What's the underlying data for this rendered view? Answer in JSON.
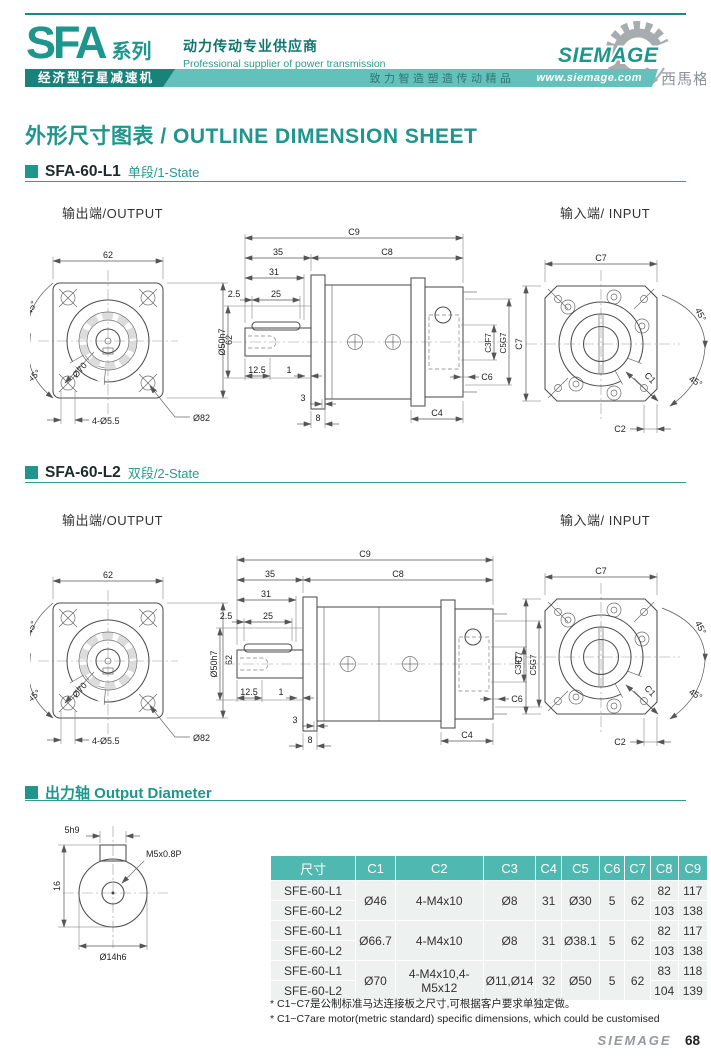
{
  "header": {
    "series": "SFA",
    "series_suffix": "系列",
    "slogan_cn": "动力传动专业供应商",
    "slogan_en": "Professional supplier of power transmission",
    "banner_product": "经济型行星减速机",
    "banner_slogan": "致力智造塑造传动精品",
    "banner_url": "www.siemage.com",
    "logo_text": "SIEMAGE",
    "logo_cn": "西馬格"
  },
  "page_title": "外形尺寸图表 / OUTLINE DIMENSION SHEET",
  "sections": {
    "s1": {
      "model": "SFA-60-L1",
      "stage": "单段/1-State"
    },
    "s2": {
      "model": "SFA-60-L2",
      "stage": "双段/2-State"
    }
  },
  "labels": {
    "output": "输出端/OUTPUT",
    "input": "输入端/ INPUT"
  },
  "dims": {
    "d62": "62",
    "angle45": "45°",
    "d70": "Ø70",
    "holes": "4-Ø5.5",
    "d82": "Ø82",
    "c9": "C9",
    "c8": "C8",
    "d35": "35",
    "d31": "31",
    "d25": "25",
    "d2_5": "2.5",
    "d50h7": "Ø50h7",
    "d12_5": "12.5",
    "d1": "1",
    "d3": "3",
    "d8": "8",
    "c3f7": "C3F7",
    "c5g7": "C5G7",
    "c6": "C6",
    "c4": "C4",
    "c7": "C7",
    "c1": "C1",
    "c2": "C2"
  },
  "output_shaft": {
    "heading": "出力轴 Output Diameter",
    "key": "5h9",
    "thread": "M5x0.8P",
    "height": "16",
    "diameter": "Ø14h6"
  },
  "table": {
    "headers": [
      "尺寸",
      "C1",
      "C2",
      "C3",
      "C4",
      "C5",
      "C6",
      "C7",
      "C8",
      "C9"
    ],
    "groups": [
      {
        "c1": "Ø46",
        "c2": "4-M4x10",
        "c3": "Ø8",
        "c4": "31",
        "c5": "Ø30",
        "c6": "5",
        "c7": "62",
        "rows": [
          {
            "model": "SFE-60-L1",
            "c8": "82",
            "c9": "117"
          },
          {
            "model": "SFE-60-L2",
            "c8": "103",
            "c9": "138"
          }
        ]
      },
      {
        "c1": "Ø66.7",
        "c2": "4-M4x10",
        "c3": "Ø8",
        "c4": "31",
        "c5": "Ø38.1",
        "c6": "5",
        "c7": "62",
        "rows": [
          {
            "model": "SFE-60-L1",
            "c8": "82",
            "c9": "117"
          },
          {
            "model": "SFE-60-L2",
            "c8": "103",
            "c9": "138"
          }
        ]
      },
      {
        "c1": "Ø70",
        "c2": "4-M4x10,4-M5x12",
        "c3": "Ø11,Ø14",
        "c4": "32",
        "c5": "Ø50",
        "c6": "5",
        "c7": "62",
        "rows": [
          {
            "model": "SFE-60-L1",
            "c8": "83",
            "c9": "118"
          },
          {
            "model": "SFE-60-L2",
            "c8": "104",
            "c9": "139"
          }
        ]
      }
    ]
  },
  "notes": {
    "cn": "* C1~C7是公制标准马达连接板之尺寸,可根据客户要求单独定做。",
    "en": "* C1~C7are motor(metric standard)  specific dimensions, which could be customised"
  },
  "footer": {
    "brand": "SIEMAGE",
    "page": "68"
  }
}
